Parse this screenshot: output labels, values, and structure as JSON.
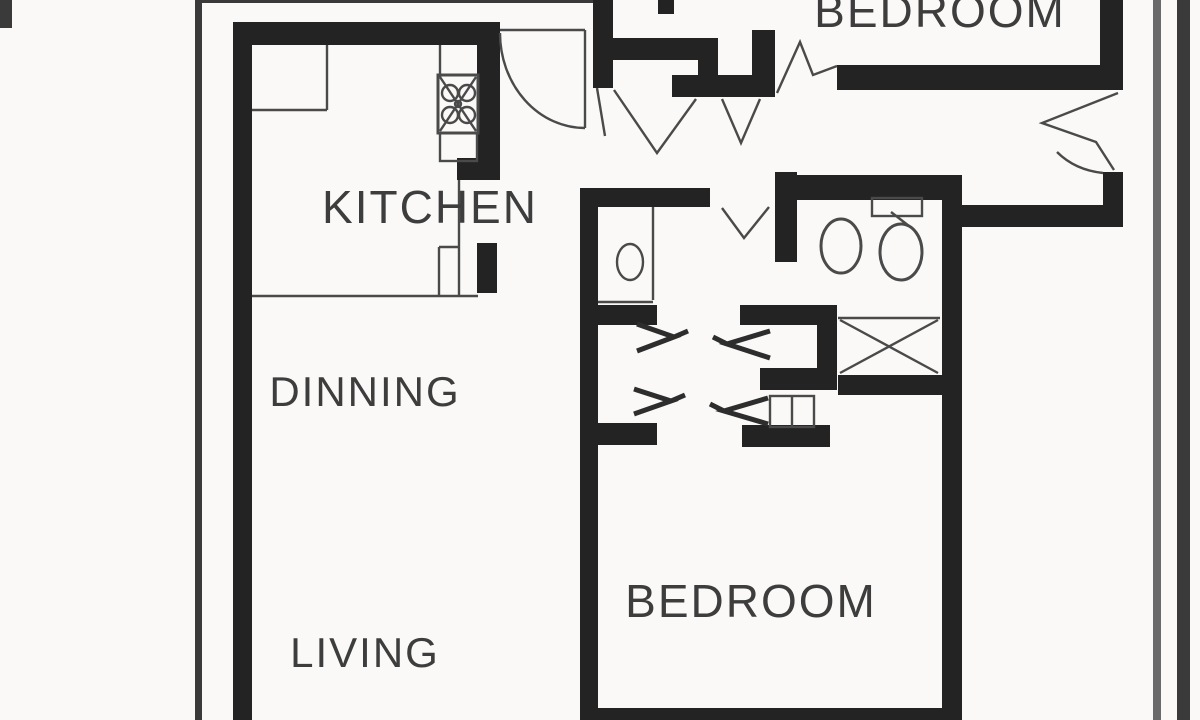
{
  "document": {
    "title": "Apartment floor plan (scanned drawing)"
  },
  "rooms": {
    "bedroom_top": {
      "label": "BEDROOM"
    },
    "kitchen": {
      "label": "KITCHEN"
    },
    "dinning": {
      "label": "DINNING"
    },
    "living": {
      "label": "LIVING"
    },
    "bedroom_bottom": {
      "label": "BEDROOM"
    }
  },
  "icons": {
    "stove": "stove-burners-icon",
    "toilet": "toilet-icon",
    "toilet_tank": "toilet-tank-icon",
    "wc_sink": "sink-oval-icon",
    "closet_cross": "crossed-box-closet-icon",
    "entry_door": "door-swing-arc-icon",
    "door_break": "wall-break-zigzag-icon",
    "sliding_door": "door-leaf-arrow-icon"
  },
  "colors": {
    "paper": "#faf9f7",
    "wall": "#232323",
    "thin": "#4a4a4a",
    "arrow": "#2d2d2d",
    "label": "#3d3d3d",
    "pageline": "#3a3a3a",
    "pageline_light": "#6a6a6a"
  }
}
